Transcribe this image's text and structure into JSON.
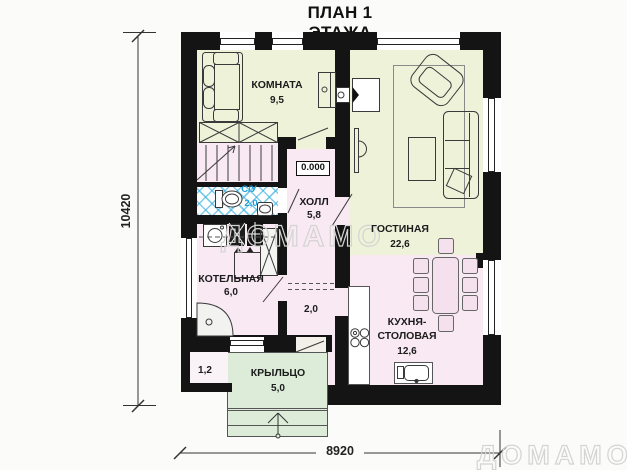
{
  "title": "ПЛАН 1 ЭТАЖА",
  "watermark": "ДОМАМО",
  "dimensions": {
    "overall_width": "8920",
    "overall_height": "10420"
  },
  "elevation": "0.000",
  "rooms": {
    "komnata": {
      "name": "КОМНАТА",
      "area": "9,5"
    },
    "gostinaya": {
      "name": "ГОСТИНАЯ",
      "area": "22,6"
    },
    "kholl": {
      "name": "ХОЛЛ",
      "area": "5,8"
    },
    "sanuzel": {
      "name": "С/У",
      "area": "2,0"
    },
    "kotelnaya": {
      "name": "КОТЕЛЬНАЯ",
      "area": "6,0"
    },
    "tambur": {
      "area": "2,0"
    },
    "kuhnya_stolovaya": {
      "name_line1": "КУХНЯ-",
      "name_line2": "СТОЛОВАЯ",
      "area": "12,6"
    },
    "kryltso": {
      "name": "КРЫЛЬЦО",
      "area": "5,0"
    },
    "kladovka": {
      "area": "1,2"
    }
  },
  "colors": {
    "wall": "#141414",
    "room_yellow": "#eef2d9",
    "room_pink": "#f8e9f2",
    "porch_green": "#dcecd8",
    "tile_blue": "#2aa9e0",
    "watermark_gray": "#d4d4d2"
  }
}
